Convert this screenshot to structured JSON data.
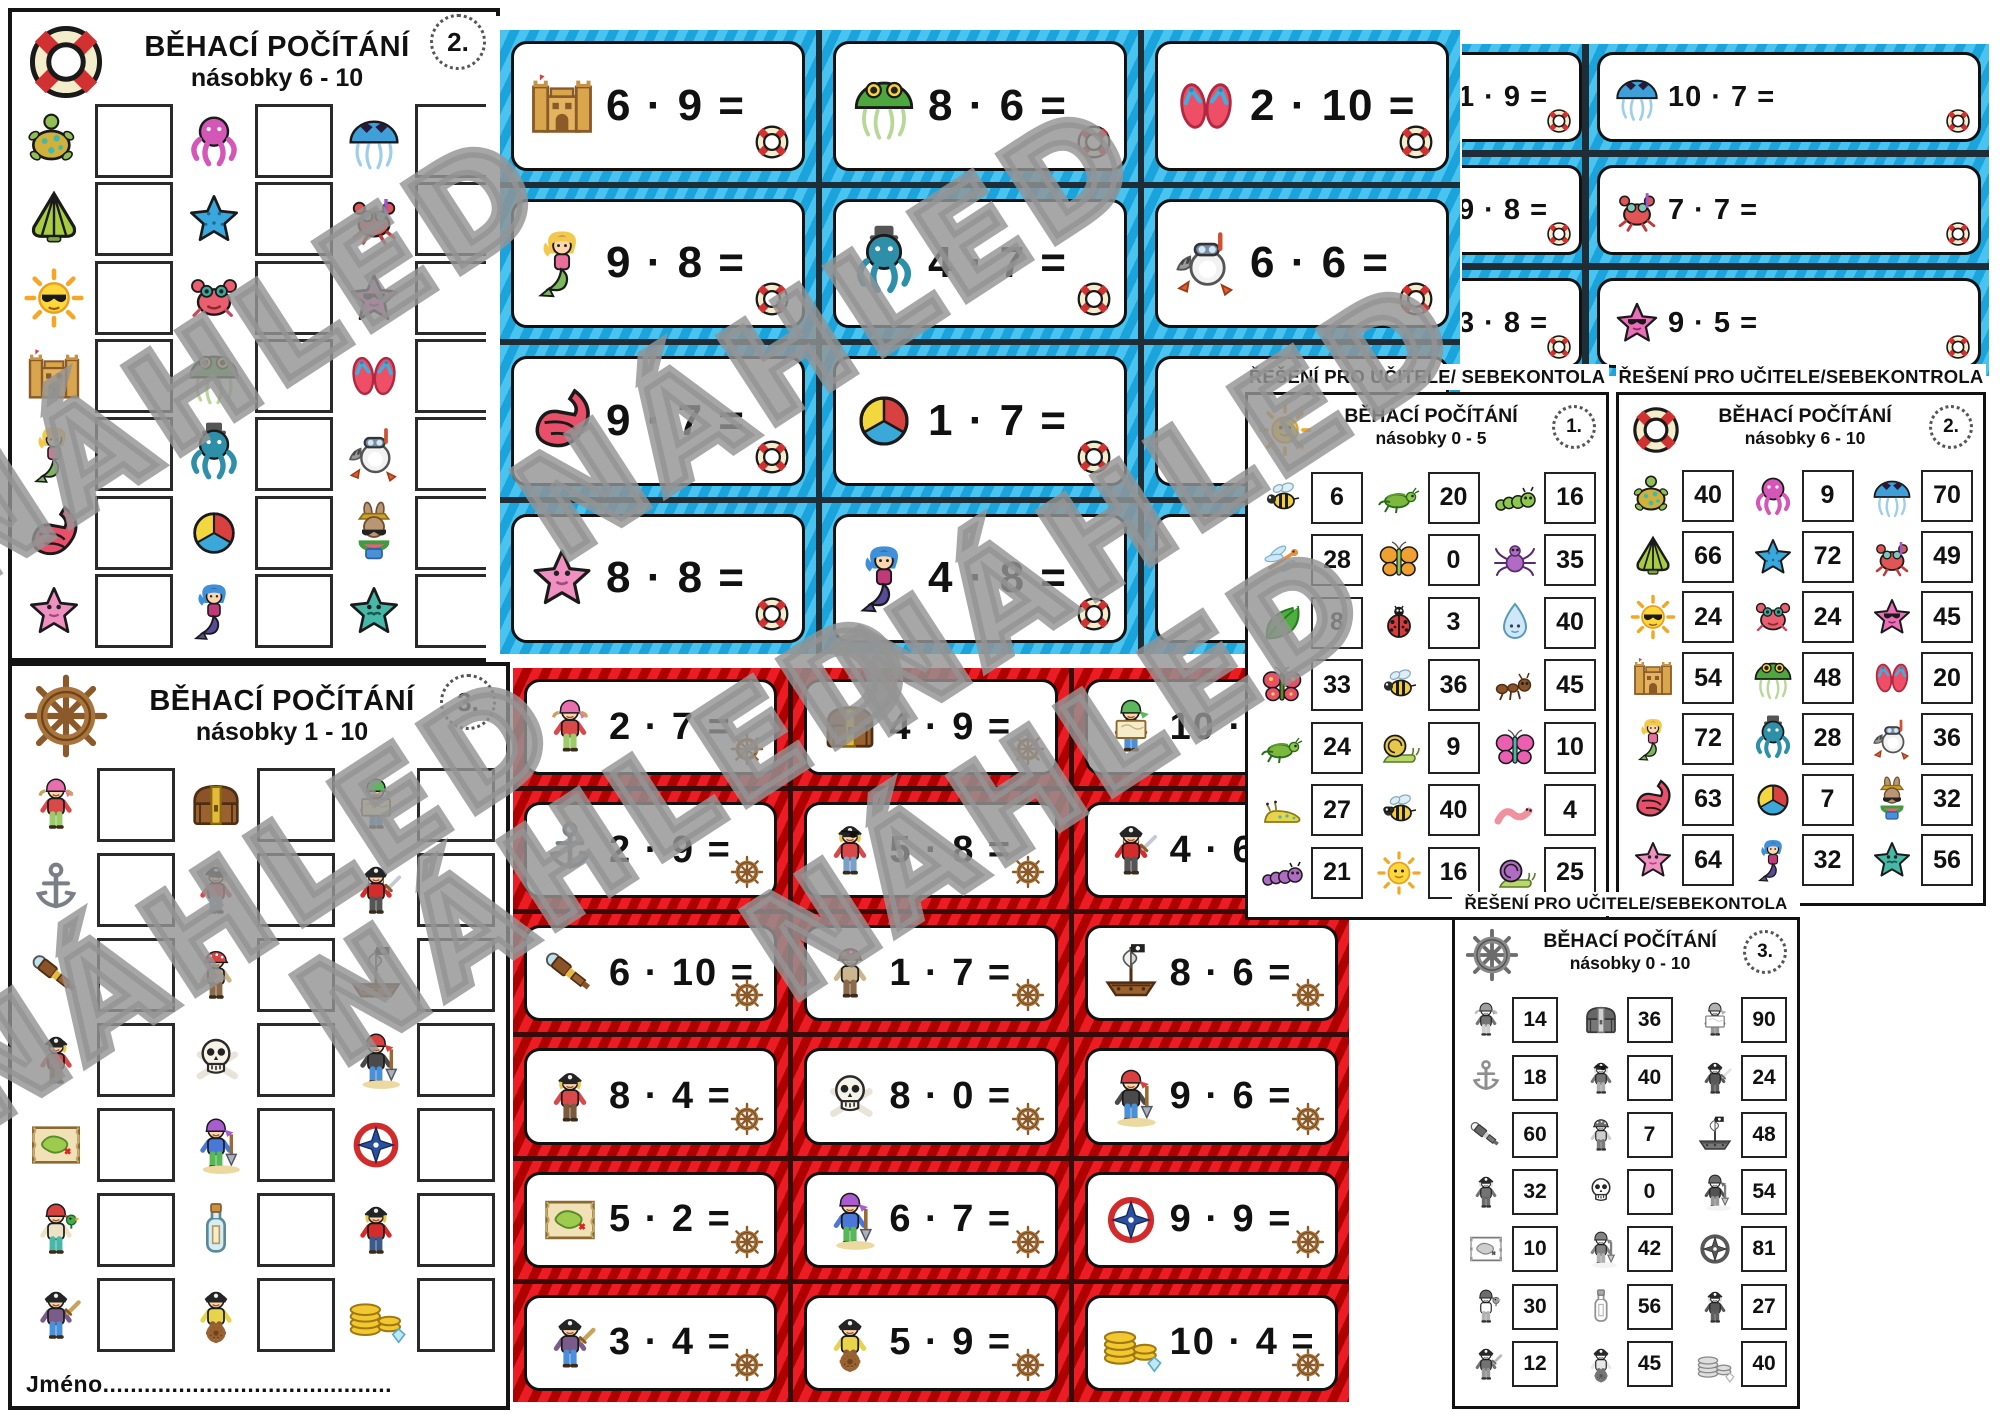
{
  "watermark_text": "NÁHLED",
  "colors": {
    "blue_card": "#1ba3dc",
    "blue_card_light": "#49c4f0",
    "red_card": "#ec1c24",
    "red_card_dark": "#ae0000",
    "page_border": "#141414"
  },
  "worksheet2": {
    "title": "BĚHACÍ POČÍTÁNÍ",
    "subtitle": "násobky 6 - 10",
    "badge": "2.",
    "corner_icon": "life-ring",
    "rows": [
      [
        "turtle",
        "octopus-pink",
        "jellyfish-blue"
      ],
      [
        "shell-green",
        "starfish-blue",
        "crab-snorkel"
      ],
      [
        "sun-shades",
        "crab-red",
        "starfish-pink-shades"
      ],
      [
        "sandcastle",
        "jellyfish-green",
        "flipflops"
      ],
      [
        "mermaid-blonde",
        "octopus-teal",
        "raccoon-snorkel"
      ],
      [
        "shell-red",
        "beachball",
        "bunny"
      ],
      [
        "starfish-pink",
        "mermaid-blue",
        "starfish-teal"
      ]
    ]
  },
  "worksheet3": {
    "title": "BĚHACÍ POČÍTÁNÍ",
    "subtitle": "násobky 1 - 10",
    "badge": "3.",
    "corner_icon": "ship-wheel",
    "name_label": "Jméno..........................................",
    "rows": [
      [
        "pirate-girl",
        "treasure-chest",
        "map-boy"
      ],
      [
        "anchor",
        "pirate-eyepatch",
        "pirate-captain"
      ],
      [
        "spyglass",
        "pirate-girl-red",
        "pirate-ship"
      ],
      [
        "pirate-blond",
        "skull",
        "boy-shovel"
      ],
      [
        "treasure-map",
        "girl-shovel",
        "compass"
      ],
      [
        "parrot-girl",
        "bottle",
        "boy-redcoat"
      ],
      [
        "boy-sword",
        "wheel-boy",
        "coins"
      ]
    ]
  },
  "blue_cards": {
    "corner_icon": "life-ring",
    "cards": [
      [
        {
          "icon": "sandcastle",
          "expr": "6 · 9 ="
        },
        {
          "icon": "jellyfish-green",
          "expr": "8 · 6 ="
        },
        {
          "icon": "flipflops",
          "expr": "2 · 10 ="
        }
      ],
      [
        {
          "icon": "mermaid-blonde",
          "expr": "9 · 8 ="
        },
        {
          "icon": "octopus-teal",
          "expr": "4 · 7 ="
        },
        {
          "icon": "raccoon-snorkel",
          "expr": "6 · 6 ="
        }
      ],
      [
        {
          "icon": "shell-red",
          "expr": "9 · 7 ="
        },
        {
          "icon": "beachball",
          "expr": "1 · 7 ="
        },
        null
      ],
      [
        {
          "icon": "starfish-pink",
          "expr": "8 · 8 ="
        },
        {
          "icon": "mermaid-blue",
          "expr": "4 · 8 ="
        },
        null
      ]
    ]
  },
  "blue_cards_back": {
    "corner_icon": "life-ring",
    "cards": [
      [
        {
          "icon": null,
          "expr": "1 · 9 ="
        },
        {
          "icon": "jellyfish-blue",
          "expr": "10 · 7 ="
        }
      ],
      [
        {
          "icon": null,
          "expr": "9 · 8 ="
        },
        {
          "icon": "crab-snorkel",
          "expr": "7 · 7 ="
        }
      ],
      [
        {
          "icon": null,
          "expr": "3 · 8 ="
        },
        {
          "icon": "starfish-pink-shades",
          "expr": "9 · 5 ="
        }
      ]
    ]
  },
  "red_cards": {
    "corner_icon": "ship-wheel",
    "cards": [
      [
        {
          "icon": "pirate-girl",
          "expr": "2 · 7 ="
        },
        {
          "icon": "treasure-chest",
          "expr": "4 · 9 ="
        },
        {
          "icon": "map-boy",
          "expr": "10 · 9 ="
        }
      ],
      [
        {
          "icon": "anchor",
          "expr": "2 · 9 ="
        },
        {
          "icon": "pirate-eyepatch",
          "expr": "5 · 8 ="
        },
        {
          "icon": "pirate-captain",
          "expr": "4 · 6 ="
        }
      ],
      [
        {
          "icon": "spyglass",
          "expr": "6 · 10 ="
        },
        {
          "icon": "pirate-girl-red",
          "expr": "1 · 7 ="
        },
        {
          "icon": "pirate-ship",
          "expr": "8 · 6 ="
        }
      ],
      [
        {
          "icon": "pirate-blond",
          "expr": "8 · 4 ="
        },
        {
          "icon": "skull",
          "expr": "8 · 0 ="
        },
        {
          "icon": "boy-shovel",
          "expr": "9 · 6 ="
        }
      ],
      [
        {
          "icon": "treasure-map",
          "expr": "5 · 2 ="
        },
        {
          "icon": "girl-shovel",
          "expr": "6 · 7 ="
        },
        {
          "icon": "compass",
          "expr": "9 · 9 ="
        }
      ],
      [
        {
          "icon": "boy-sword",
          "expr": "3 · 4 ="
        },
        {
          "icon": "wheel-boy",
          "expr": "5 · 9 ="
        },
        {
          "icon": "coins",
          "expr": "10 · 4 ="
        }
      ]
    ]
  },
  "answers1": {
    "header": "ŘEŠENÍ PRO UČITELE/ SEBEKONTOLA",
    "title": "BĚHACÍ POČÍTÁNÍ",
    "subtitle": "násobky 0 - 5",
    "badge": "1.",
    "corner_icon": "sun",
    "rows": [
      [
        {
          "icon": "bee",
          "value": "6"
        },
        {
          "icon": "grasshopper",
          "value": "20"
        },
        {
          "icon": "caterpillar-green",
          "value": "16"
        }
      ],
      [
        {
          "icon": "dragonfly",
          "value": "28"
        },
        {
          "icon": "butterfly-orange",
          "value": "0"
        },
        {
          "icon": "spider",
          "value": "35"
        }
      ],
      [
        {
          "icon": "leaf",
          "value": "8"
        },
        {
          "icon": "ladybug",
          "value": "3"
        },
        {
          "icon": "water-drop",
          "value": "40"
        }
      ],
      [
        {
          "icon": "butterfly-red",
          "value": "33"
        },
        {
          "icon": "bee",
          "value": "36"
        },
        {
          "icon": "ant",
          "value": "45"
        }
      ],
      [
        {
          "icon": "grasshopper",
          "value": "24"
        },
        {
          "icon": "snail-yellow",
          "value": "9"
        },
        {
          "icon": "butterfly-pink",
          "value": "10"
        }
      ],
      [
        {
          "icon": "slug",
          "value": "27"
        },
        {
          "icon": "bee-glasses",
          "value": "40"
        },
        {
          "icon": "worm",
          "value": "4"
        }
      ],
      [
        {
          "icon": "caterpillar-purple",
          "value": "21"
        },
        {
          "icon": "sun",
          "value": "16"
        },
        {
          "icon": "snail-purple",
          "value": "25"
        }
      ]
    ]
  },
  "answers2": {
    "header": "ŘEŠENÍ PRO UČITELE/SEBEKONTROLA",
    "title": "BĚHACÍ POČÍTÁNÍ",
    "subtitle": "násobky 6 - 10",
    "badge": "2.",
    "corner_icon": "life-ring",
    "rows": [
      [
        {
          "icon": "turtle",
          "value": "40"
        },
        {
          "icon": "octopus-pink",
          "value": "9"
        },
        {
          "icon": "jellyfish-blue",
          "value": "70"
        }
      ],
      [
        {
          "icon": "shell-green",
          "value": "66"
        },
        {
          "icon": "starfish-blue",
          "value": "72"
        },
        {
          "icon": "crab-snorkel",
          "value": "49"
        }
      ],
      [
        {
          "icon": "sun-shades",
          "value": "24"
        },
        {
          "icon": "crab-red",
          "value": "24"
        },
        {
          "icon": "starfish-pink-shades",
          "value": "45"
        }
      ],
      [
        {
          "icon": "sandcastle",
          "value": "54"
        },
        {
          "icon": "jellyfish-green",
          "value": "48"
        },
        {
          "icon": "flipflops",
          "value": "20"
        }
      ],
      [
        {
          "icon": "mermaid-blonde",
          "value": "72"
        },
        {
          "icon": "octopus-teal",
          "value": "28"
        },
        {
          "icon": "raccoon-snorkel",
          "value": "36"
        }
      ],
      [
        {
          "icon": "shell-red",
          "value": "63"
        },
        {
          "icon": "beachball",
          "value": "7"
        },
        {
          "icon": "bunny",
          "value": "32"
        }
      ],
      [
        {
          "icon": "starfish-pink",
          "value": "64"
        },
        {
          "icon": "mermaid-blue",
          "value": "32"
        },
        {
          "icon": "starfish-teal",
          "value": "56"
        }
      ]
    ]
  },
  "answers3": {
    "header": "ŘEŠENÍ PRO UČITELE/SEBEKONTOLA",
    "title": "BĚHACÍ POČÍTÁNÍ",
    "subtitle": "násobky 0 - 10",
    "badge": "3.",
    "corner_icon": "ship-wheel",
    "rows": [
      [
        {
          "icon": "pirate-girl",
          "value": "14"
        },
        {
          "icon": "treasure-chest",
          "value": "36"
        },
        {
          "icon": "map-boy",
          "value": "90"
        }
      ],
      [
        {
          "icon": "anchor",
          "value": "18"
        },
        {
          "icon": "pirate-eyepatch",
          "value": "40"
        },
        {
          "icon": "pirate-captain",
          "value": "24"
        }
      ],
      [
        {
          "icon": "spyglass",
          "value": "60"
        },
        {
          "icon": "pirate-girl-red",
          "value": "7"
        },
        {
          "icon": "pirate-ship",
          "value": "48"
        }
      ],
      [
        {
          "icon": "pirate-blond",
          "value": "32"
        },
        {
          "icon": "skull",
          "value": "0"
        },
        {
          "icon": "boy-shovel",
          "value": "54"
        }
      ],
      [
        {
          "icon": "treasure-map",
          "value": "10"
        },
        {
          "icon": "girl-shovel",
          "value": "42"
        },
        {
          "icon": "compass",
          "value": "81"
        }
      ],
      [
        {
          "icon": "parrot-girl",
          "value": "30"
        },
        {
          "icon": "bottle",
          "value": "56"
        },
        {
          "icon": "boy-redcoat",
          "value": "27"
        }
      ],
      [
        {
          "icon": "boy-sword",
          "value": "12"
        },
        {
          "icon": "wheel-boy",
          "value": "45"
        },
        {
          "icon": "coins",
          "value": "40"
        }
      ]
    ]
  }
}
